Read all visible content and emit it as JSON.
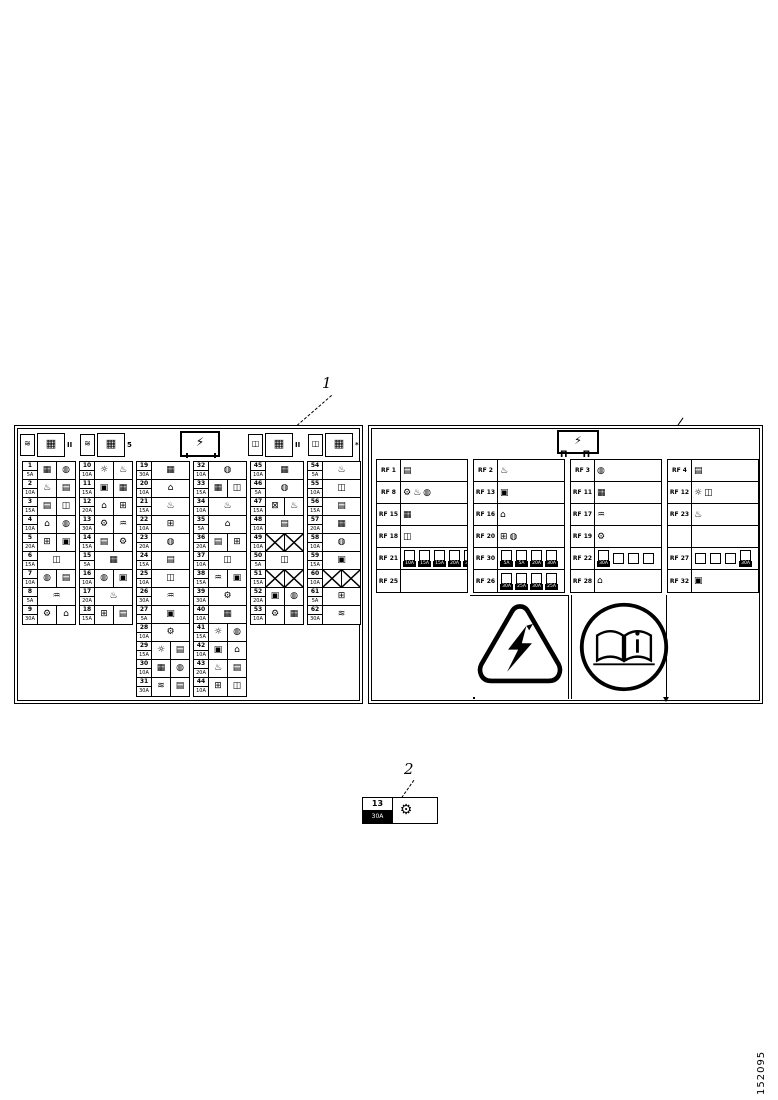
{
  "figure": {
    "callout1": "1",
    "callout2": "2",
    "part_number": "152095"
  },
  "colors": {
    "ink": "#000000",
    "paper": "#ffffff"
  },
  "left_panel": {
    "header": {
      "center_icon": "⚡",
      "groups": [
        {
          "glyph": "≋",
          "box": "▦",
          "tag": "II"
        },
        {
          "glyph": "≋",
          "box": "▦",
          "tag": "5"
        },
        {
          "glyph": "◫",
          "box": "▦",
          "tag": "II"
        },
        {
          "glyph": "◫",
          "box": "▦",
          "tag": "*"
        }
      ]
    },
    "groups": [
      {
        "rows": [
          [
            "1",
            "5A",
            [
              "▦",
              "◍"
            ]
          ],
          [
            "2",
            "10A",
            [
              "♨",
              "▤"
            ]
          ],
          [
            "3",
            "15A",
            [
              "▤",
              "◫"
            ]
          ],
          [
            "4",
            "10A",
            [
              "⌂",
              "◍"
            ]
          ],
          [
            "5",
            "20A",
            [
              "⊞",
              "▣"
            ]
          ],
          [
            "6",
            "15A",
            [
              "◫"
            ]
          ],
          [
            "7",
            "10A",
            [
              "◍",
              "▤"
            ]
          ],
          [
            "8",
            "5A",
            [
              "♒"
            ]
          ],
          [
            "9",
            "30A",
            [
              "⚙",
              "⌂"
            ]
          ]
        ]
      },
      {
        "rows": [
          [
            "10",
            "10A",
            [
              "☼",
              "♨"
            ]
          ],
          [
            "11",
            "15A",
            [
              "▣",
              "▦"
            ]
          ],
          [
            "12",
            "20A",
            [
              "⌂",
              "⊞"
            ]
          ],
          [
            "13",
            "30A",
            [
              "⚙",
              "♒"
            ]
          ],
          [
            "14",
            "15A",
            [
              "▤",
              "⚙"
            ]
          ],
          [
            "15",
            "5A",
            [
              "▦"
            ]
          ],
          [
            "16",
            "10A",
            [
              "◍",
              "▣"
            ]
          ],
          [
            "17",
            "20A",
            [
              "♨"
            ]
          ],
          [
            "18",
            "15A",
            [
              "⊞",
              "▤"
            ]
          ]
        ]
      },
      {
        "rows": [
          [
            "19",
            "30A",
            [
              "▦"
            ]
          ],
          [
            "20",
            "10A",
            [
              "⌂"
            ]
          ],
          [
            "21",
            "15A",
            [
              "♨"
            ]
          ],
          [
            "22",
            "10A",
            [
              "⊞"
            ]
          ],
          [
            "23",
            "20A",
            [
              "◍"
            ]
          ],
          [
            "24",
            "15A",
            [
              "▤"
            ]
          ],
          [
            "25",
            "10A",
            [
              "◫"
            ]
          ],
          [
            "26",
            "30A",
            [
              "♒"
            ]
          ],
          [
            "27",
            "5A",
            [
              "▣"
            ]
          ],
          [
            "28",
            "10A",
            [
              "⚙"
            ]
          ],
          [
            "29",
            "15A",
            [
              "☼",
              "▤"
            ]
          ],
          [
            "30",
            "10A",
            [
              "▦",
              "◍"
            ]
          ],
          [
            "31",
            "30A",
            [
              "≋",
              "▤"
            ]
          ]
        ]
      },
      {
        "rows": [
          [
            "32",
            "10A",
            [
              "◍"
            ]
          ],
          [
            "33",
            "15A",
            [
              "▦",
              "◫"
            ]
          ],
          [
            "34",
            "10A",
            [
              "♨"
            ]
          ],
          [
            "35",
            "5A",
            [
              "⌂"
            ]
          ],
          [
            "36",
            "20A",
            [
              "▤",
              "⊞"
            ]
          ],
          [
            "37",
            "10A",
            [
              "◫"
            ]
          ],
          [
            "38",
            "15A",
            [
              "♒",
              "▣"
            ]
          ],
          [
            "39",
            "30A",
            [
              "⚙"
            ]
          ],
          [
            "40",
            "10A",
            [
              "▦"
            ]
          ],
          [
            "41",
            "15A",
            [
              "☼",
              "◍"
            ]
          ],
          [
            "42",
            "10A",
            [
              "▣",
              "⌂"
            ]
          ],
          [
            "43",
            "20A",
            [
              "♨",
              "▤"
            ]
          ],
          [
            "44",
            "10A",
            [
              "⊞",
              "◫"
            ]
          ]
        ]
      },
      {
        "rows": [
          [
            "45",
            "10A",
            [
              "▦"
            ]
          ],
          [
            "46",
            "5A",
            [
              "◍"
            ]
          ],
          [
            "47",
            "15A",
            [
              "⊠",
              "♨"
            ]
          ],
          [
            "48",
            "10A",
            [
              "▤"
            ]
          ],
          [
            "49",
            "10A",
            [
              "X",
              "X"
            ]
          ],
          [
            "50",
            "5A",
            [
              "◫"
            ]
          ],
          [
            "51",
            "15A",
            [
              "X",
              "X"
            ]
          ],
          [
            "52",
            "20A",
            [
              "▣",
              "◍"
            ]
          ],
          [
            "53",
            "10A",
            [
              "⚙",
              "▦"
            ]
          ]
        ]
      },
      {
        "rows": [
          [
            "54",
            "5A",
            [
              "♨"
            ]
          ],
          [
            "55",
            "10A",
            [
              "◫"
            ]
          ],
          [
            "56",
            "15A",
            [
              "▤"
            ]
          ],
          [
            "57",
            "20A",
            [
              "▦"
            ]
          ],
          [
            "58",
            "10A",
            [
              "◍"
            ]
          ],
          [
            "59",
            "15A",
            [
              "▣"
            ]
          ],
          [
            "60",
            "10A",
            [
              "X",
              "X"
            ]
          ],
          [
            "61",
            "5A",
            [
              "⊞"
            ]
          ],
          [
            "62",
            "30A",
            [
              "≋"
            ]
          ]
        ]
      }
    ]
  },
  "right_panel": {
    "header": {
      "icon": "⚡",
      "pins": "Π Π"
    },
    "columns": [
      {
        "rows": [
          {
            "label": "RF 1",
            "icons": [
              "▤"
            ]
          },
          {
            "label": "RF 8",
            "icons": [
              "⚙",
              "♨",
              "◍"
            ]
          },
          {
            "label": "RF 15",
            "icons": [
              "▦"
            ]
          },
          {
            "label": "RF 18",
            "icons": [
              "◫"
            ]
          },
          {
            "label": "RF 21",
            "sub": [
              "10A",
              "15A",
              "15A",
              "20A",
              "30A"
            ]
          },
          {
            "label": "RF 25",
            "icons": []
          }
        ]
      },
      {
        "rows": [
          {
            "label": "RF 2",
            "icons": [
              "♨"
            ]
          },
          {
            "label": "RF 13",
            "icons": [
              "▣"
            ]
          },
          {
            "label": "RF 16",
            "icons": [
              "⌂"
            ]
          },
          {
            "label": "RF 20",
            "icons": [
              "⊞",
              "◍"
            ]
          },
          {
            "label": "RF 30",
            "sub": [
              "5A",
              "5A",
              "20A",
              "30A"
            ]
          },
          {
            "label": "RF 26",
            "sub": [
              "30A",
              "25A",
              "30A",
              "25A"
            ]
          }
        ]
      },
      {
        "rows": [
          {
            "label": "RF 3",
            "icons": [
              "◍"
            ]
          },
          {
            "label": "RF 11",
            "icons": [
              "▦"
            ]
          },
          {
            "label": "RF 17",
            "icons": [
              "♒"
            ]
          },
          {
            "label": "RF 19",
            "icons": [
              "⚙"
            ]
          },
          {
            "label": "RF 22",
            "sub": [
              "30A",
              "",
              "",
              ""
            ]
          },
          {
            "label": "RF 28",
            "icons": [
              "⌂"
            ]
          }
        ]
      },
      {
        "rows": [
          {
            "label": "RF 4",
            "icons": [
              "▤"
            ]
          },
          {
            "label": "RF 12",
            "icons": [
              "☼",
              "◫"
            ]
          },
          {
            "label": "RF 23",
            "icons": [
              "♨"
            ]
          },
          {
            "label": "",
            "icons": []
          },
          {
            "label": "RF 27",
            "sub": [
              "",
              "",
              "",
              "30A"
            ]
          },
          {
            "label": "RF 32",
            "icons": [
              "▣"
            ]
          }
        ]
      }
    ],
    "symbols": {
      "triangle": "high-voltage-warning-triangle",
      "circle": "read-operators-manual"
    }
  },
  "item2": {
    "n": "13",
    "a": "30A",
    "icon": "⚙"
  }
}
